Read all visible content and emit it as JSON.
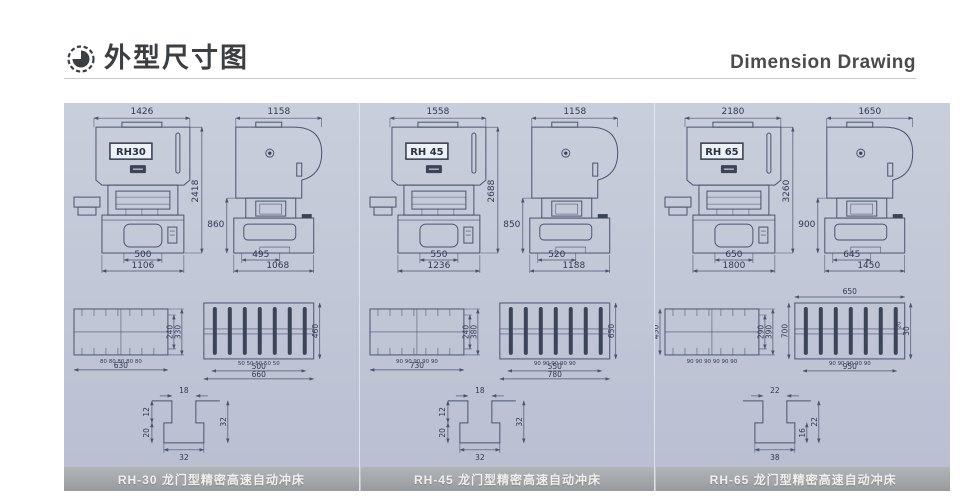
{
  "header": {
    "title_cn": "外型尺寸图",
    "title_en": "Dimension Drawing",
    "logo_icon": "pie-chart-icon"
  },
  "colors": {
    "panel_bg": "#c0c6d6",
    "drawing_line": "#4a546e",
    "caption_bar": "#a3a6a9",
    "caption_text": "#efefed",
    "header_text": "#3b3f42"
  },
  "columns": [
    {
      "caption": "RH-30 龙门型精密高速自动冲床",
      "front": {
        "model": "RH30",
        "width": "1426",
        "height": "2418",
        "bolster": "500",
        "base": "1106"
      },
      "side": {
        "width": "1158",
        "height": "860",
        "bolster": "495",
        "base": "1068"
      },
      "plate_left": {
        "left": "",
        "right_inner": "240",
        "right_outer": "330",
        "spacing": "80 80 80 80 80",
        "bottom": "630"
      },
      "plate_right": {
        "top": "",
        "left": "",
        "right": "460",
        "small": "",
        "spacing": "50 50 50 50 50",
        "bottom_a": "500",
        "bottom_b": "660"
      },
      "tslot": {
        "top": "18",
        "left_a": "12",
        "left_b": "20",
        "right_a": "32",
        "right_b": "",
        "bottom": "32"
      }
    },
    {
      "caption": "RH-45 龙门型精密高速自动冲床",
      "front": {
        "model": "RH 45",
        "width": "1558",
        "height": "2688",
        "bolster": "550",
        "base": "1236"
      },
      "side": {
        "width": "1158",
        "height": "850",
        "bolster": "520",
        "base": "1188"
      },
      "plate_left": {
        "left": "",
        "right_inner": "240",
        "right_outer": "380",
        "spacing": "90 90 90 90 90",
        "bottom": "730"
      },
      "plate_right": {
        "top": "",
        "left": "",
        "right": "650",
        "small": "",
        "spacing": "90 90 90 90 90",
        "bottom_a": "550",
        "bottom_b": "780"
      },
      "tslot": {
        "top": "18",
        "left_a": "12",
        "left_b": "20",
        "right_a": "32",
        "right_b": "",
        "bottom": "32"
      }
    },
    {
      "caption": "RH-65 龙门型精密高速自动冲床",
      "front": {
        "model": "RH 65",
        "width": "2180",
        "height": "3260",
        "bolster": "650",
        "base": "1800"
      },
      "side": {
        "width": "1650",
        "height": "900",
        "bolster": "645",
        "base": "1450"
      },
      "plate_left": {
        "left": "450",
        "right_inner": "290",
        "right_outer": "390",
        "spacing": "90 90 90 90 90 90",
        "bottom": ""
      },
      "plate_right": {
        "top": "650",
        "left": "700",
        "right": "30",
        "small": "20",
        "spacing": "90 90 90 90 90",
        "bottom_a": "950",
        "bottom_b": ""
      },
      "tslot": {
        "top": "22",
        "left_a": "",
        "left_b": "",
        "right_a": "22",
        "right_b": "16",
        "bottom": "38"
      }
    }
  ]
}
